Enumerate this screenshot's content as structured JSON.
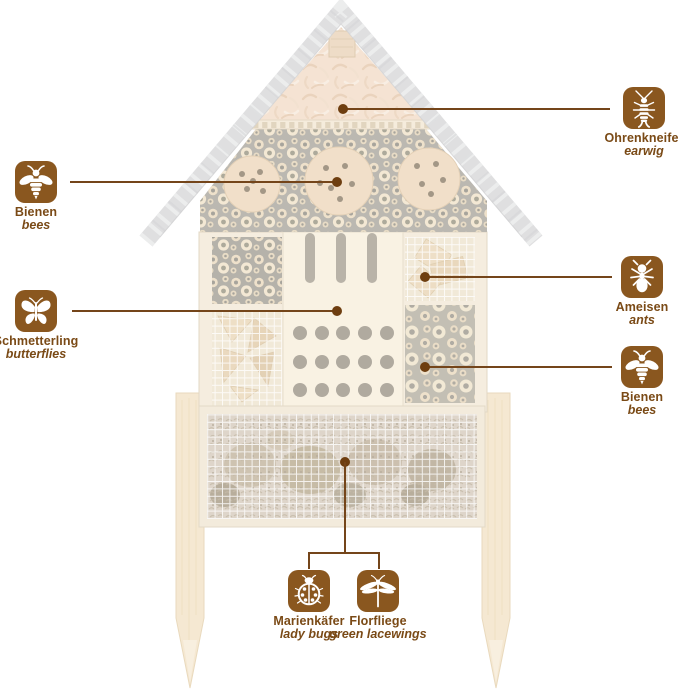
{
  "colors": {
    "accent_brown": "#8a571f",
    "line_brown": "#74451a",
    "dot_brown": "#6e3e10",
    "text_brown": "#7a4a16",
    "roof_gray": "#d6d6d8",
    "wood_cream": "#f2e8d6"
  },
  "callouts": {
    "earwig": {
      "name_de": "Ohrenkneifer",
      "name_en": "earwig",
      "icon": "earwig-icon"
    },
    "bees_upper": {
      "name_de": "Bienen",
      "name_en": "bees",
      "icon": "bee-icon"
    },
    "butterflies": {
      "name_de": "Schmetterling",
      "name_en": "butterflies",
      "icon": "butterfly-icon"
    },
    "ants": {
      "name_de": "Ameisen",
      "name_en": "ants",
      "icon": "ant-icon"
    },
    "bees_lower": {
      "name_de": "Bienen",
      "name_en": "bees",
      "icon": "bee-icon"
    },
    "ladybugs": {
      "name_de": "Marienkäfer",
      "name_en": "lady bugs",
      "icon": "ladybug-icon"
    },
    "lacewings": {
      "name_de": "Florfliege",
      "name_en": "green lacewings",
      "icon": "lacewing-icon"
    }
  }
}
